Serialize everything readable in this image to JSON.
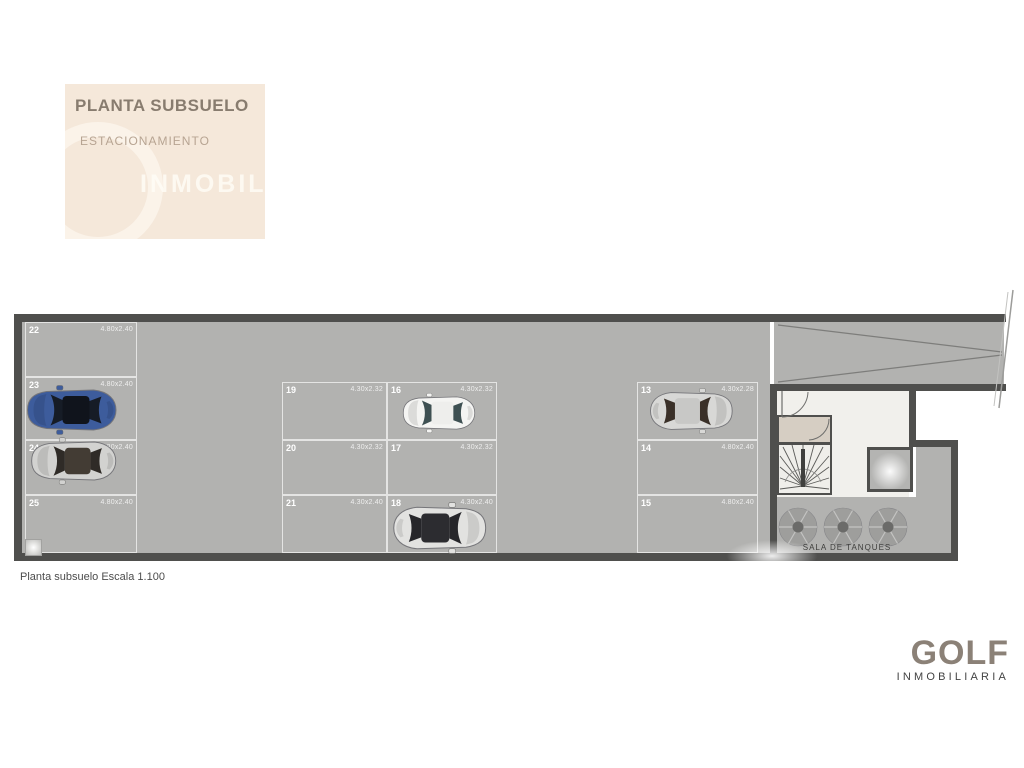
{
  "header": {
    "title": "PLANTA SUBSUELO",
    "subtitle": "ESTACIONAMIENTO",
    "watermark": "INMOBILIA",
    "bg_color": "#f5e8da"
  },
  "caption": "Planta subsuelo Escala 1.100",
  "brand": {
    "name": "GOLF",
    "tagline": "INMOBILIARIA"
  },
  "plan": {
    "tanks_room_label": "SALA DE TANQUES",
    "colors": {
      "floor": "#b2b2b0",
      "wall": "#4f4f4d",
      "car_blue": "#3d5c9c"
    },
    "spaces": [
      {
        "number": "22",
        "dim": "4.80x2.40",
        "x": 25,
        "y": 322,
        "w": 112,
        "h": 55
      },
      {
        "number": "23",
        "dim": "4.80x2.40",
        "x": 25,
        "y": 377,
        "w": 112,
        "h": 63
      },
      {
        "number": "24",
        "dim": "4.80x2.40",
        "x": 25,
        "y": 440,
        "w": 112,
        "h": 55
      },
      {
        "number": "25",
        "dim": "4.80x2.40",
        "x": 25,
        "y": 495,
        "w": 112,
        "h": 58
      },
      {
        "number": "19",
        "dim": "4.30x2.32",
        "x": 282,
        "y": 382,
        "w": 105,
        "h": 58
      },
      {
        "number": "20",
        "dim": "4.30x2.32",
        "x": 282,
        "y": 440,
        "w": 105,
        "h": 55
      },
      {
        "number": "21",
        "dim": "4.30x2.40",
        "x": 282,
        "y": 495,
        "w": 105,
        "h": 58
      },
      {
        "number": "16",
        "dim": "4.30x2.32",
        "x": 387,
        "y": 382,
        "w": 110,
        "h": 58
      },
      {
        "number": "17",
        "dim": "4.30x2.32",
        "x": 387,
        "y": 440,
        "w": 110,
        "h": 55
      },
      {
        "number": "18",
        "dim": "4.30x2.40",
        "x": 387,
        "y": 495,
        "w": 110,
        "h": 58
      },
      {
        "number": "13",
        "dim": "4.30x2.28",
        "x": 637,
        "y": 382,
        "w": 121,
        "h": 58
      },
      {
        "number": "14",
        "dim": "4.80x2.40",
        "x": 637,
        "y": 440,
        "w": 121,
        "h": 55
      },
      {
        "number": "15",
        "dim": "4.80x2.40",
        "x": 637,
        "y": 495,
        "w": 121,
        "h": 58
      }
    ],
    "cars": [
      {
        "space": "23",
        "x": 20,
        "y": 384,
        "w": 101,
        "h": 52,
        "body": "#3d5c9c",
        "glass": "#161c26",
        "roof": "#10141c",
        "flip": false
      },
      {
        "space": "24",
        "x": 25,
        "y": 434,
        "w": 95,
        "h": 54,
        "body": "#d2d2d0",
        "glass": "#2f2b27",
        "roof": "#433c34",
        "flip": false
      },
      {
        "space": "16",
        "x": 391,
        "y": 392,
        "w": 94,
        "h": 42,
        "body": "#f4f4f2",
        "glass": "#3e5052",
        "roof": "#eeeeec",
        "flip": false
      },
      {
        "space": "18",
        "x": 389,
        "y": 501,
        "w": 104,
        "h": 54,
        "body": "#e2e2e0",
        "glass": "#26262a",
        "roof": "#2c2c30",
        "flip": true
      },
      {
        "space": "13",
        "x": 643,
        "y": 387,
        "w": 99,
        "h": 48,
        "body": "#d8d8d6",
        "glass": "#3a3028",
        "roof": "#c8c8c6",
        "flip": true
      }
    ],
    "tanks": [
      {
        "cx": 798,
        "cy": 527,
        "r": 19
      },
      {
        "cx": 843,
        "cy": 527,
        "r": 19
      },
      {
        "cx": 888,
        "cy": 527,
        "r": 19
      }
    ]
  }
}
